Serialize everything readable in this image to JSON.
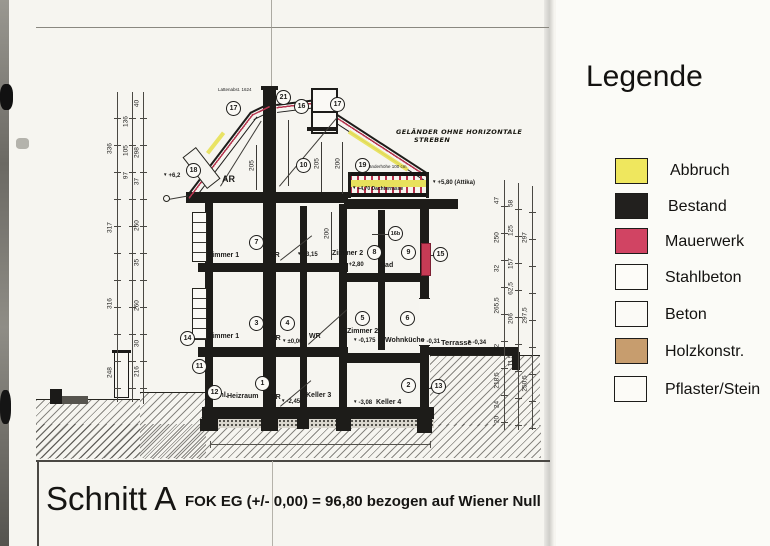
{
  "legend": {
    "title": "Legende",
    "items": [
      {
        "label": "Abbruch",
        "color": "#efe75e"
      },
      {
        "label": "Bestand",
        "color": "#22201e"
      },
      {
        "label": "Mauerwerk",
        "color": "#d14463"
      },
      {
        "label": "Stahlbeton",
        "color": "#fdfcf8"
      },
      {
        "label": "Beton",
        "color": "#fbfaf6"
      },
      {
        "label": "Holzkonstr.",
        "color": "#c79d6e"
      },
      {
        "label": "Pflaster/Stein",
        "color": "#fcfbf7"
      }
    ]
  },
  "title_block": {
    "section": "Schnitt A",
    "datum": "FOK EG (+/- 0,00) = 96,80 bezogen auf Wiener Null"
  },
  "rooms": [
    "AR",
    "Zimmer 1",
    "VR",
    "Zimmer 2",
    "Bad",
    "Zimmer 1",
    "VR",
    "WR",
    "Zimmer 2",
    "Wohnküche",
    "Terrasse",
    "Schl.",
    "Heizraum",
    "VR",
    "Keller 3",
    "Keller 4"
  ],
  "markers": [
    "1",
    "2",
    "3",
    "4",
    "5",
    "6",
    "7",
    "8",
    "9",
    "10",
    "11",
    "12",
    "13",
    "14",
    "15",
    "16",
    "16b",
    "17",
    "17",
    "18",
    "19",
    "21"
  ],
  "levels": [
    "+6,2",
    "+5,80 (Attika)",
    "+4,70 Dachterrasse",
    "+3,15",
    "+2,80",
    "±0,00",
    "-0,175",
    "-0,31",
    "-0,34",
    "-2,45",
    "-3,08"
  ],
  "dims": {
    "left1": [
      "336",
      "317",
      "316",
      "248"
    ],
    "left2": [
      "136",
      "105",
      "97"
    ],
    "left3": [
      "40",
      "298",
      "37",
      "260",
      "35",
      "260",
      "30",
      "216"
    ],
    "right1": [
      "47",
      "250",
      "32",
      "265,5",
      "32",
      "218,5",
      "24",
      "20"
    ],
    "right2": [
      "58",
      "125",
      "157",
      "62,5",
      "206",
      "11,5"
    ],
    "right3": [
      "297",
      "297,5",
      "250,5"
    ],
    "attic": [
      "205",
      "205",
      "200"
    ],
    "og": [
      "200"
    ]
  },
  "notes": {
    "gelaender_hoehe": "Geländerhöhe 100 cm",
    "railing_line1": "GELÄNDER OHNE HORIZONTALE",
    "railing_line2": "STREBEN",
    "roof": "Lattenabst. 1624"
  }
}
